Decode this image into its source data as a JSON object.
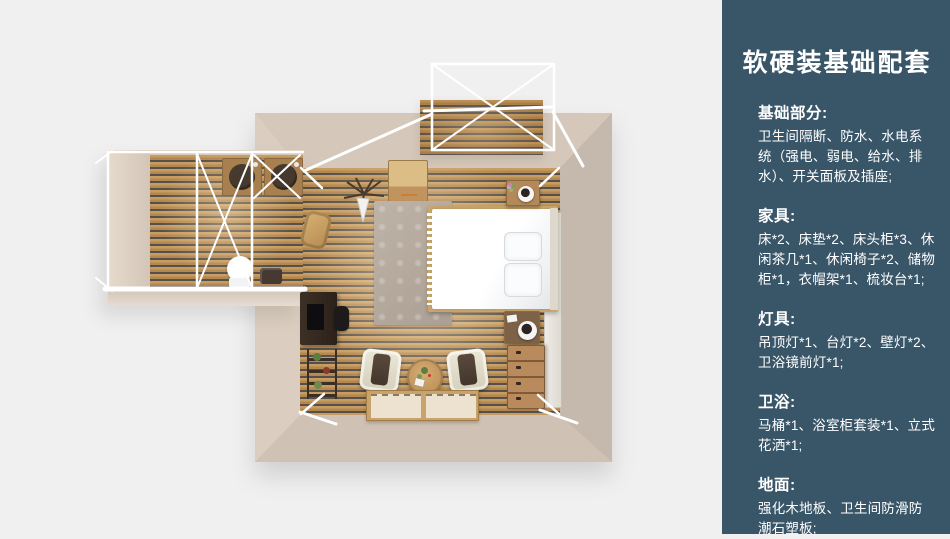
{
  "page": {
    "background_color": "#f0f0f0"
  },
  "sidebar": {
    "background_color": "#395669",
    "text_color": "#ffffff",
    "title": "软硬装基础配套",
    "sections": [
      {
        "heading": "基础部分:",
        "body": "卫生间隔断、防水、水电系统（强电、弱电、给水、排水）、开关面板及插座;"
      },
      {
        "heading": "家具:",
        "body": "床*2、床垫*2、床头柜*3、休闲茶几*1、休闲椅子*2、储物柜*1，衣帽架*1、梳妆台*1;"
      },
      {
        "heading": "灯具:",
        "body": "吊顶灯*1、台灯*2、壁灯*2、卫浴镜前灯*1;"
      },
      {
        "heading": "卫浴:",
        "body": "马桶*1、浴室柜套装*1、立式花洒*1;"
      },
      {
        "heading": "地面:",
        "body": "强化木地板、卫生间防滑防潮石塑板;"
      }
    ]
  },
  "floor_plan": {
    "view": "top-down 3D render",
    "areas": [
      "bedroom",
      "bathroom",
      "balcony"
    ],
    "furniture": [
      "bed",
      "pillows",
      "rug",
      "storage-cabinet",
      "clothes-rack",
      "nightstand-top",
      "nightstand-bottom",
      "dresser",
      "wardrobe-door-panel",
      "desk",
      "desk-chair",
      "plant-shelf",
      "lounge-chair-left",
      "lounge-chair-right",
      "round-coffee-table",
      "tatami-mats",
      "vanity-sink-left",
      "vanity-sink-right",
      "toilet",
      "wood-basket"
    ],
    "colors": {
      "wall": "#cfc1b3",
      "wood_floor": "#c79c60",
      "floor_gap": "#56504c",
      "frame_lines": "#ffffff",
      "bed": "#ffffff"
    }
  }
}
